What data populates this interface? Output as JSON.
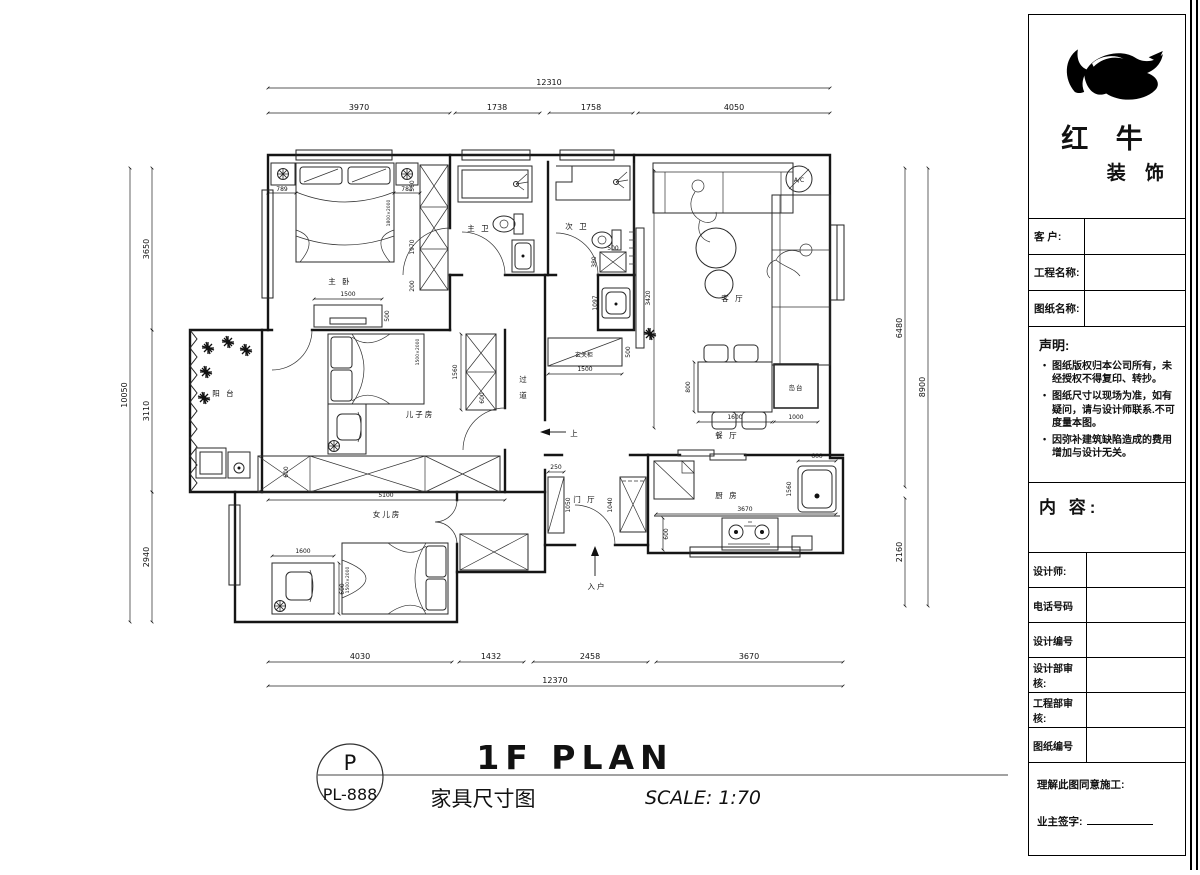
{
  "sidebar": {
    "brand_1": "红 牛",
    "brand_2": "装 饰",
    "fields_top": [
      {
        "label": "客  户:"
      },
      {
        "label": "工程名称:"
      },
      {
        "label": "图纸名称:"
      }
    ],
    "statement_title": "声明:",
    "statement_items": [
      "图纸版权归本公司所有，未经授权不得复印、转抄。",
      "图纸尺寸以现场为准，如有疑问，请与设计师联系.不可度量本图。",
      "因弥补建筑缺陷造成的费用增加与设计无关。"
    ],
    "content_label": "内 容:",
    "fields_bottom": [
      {
        "label": "设计师:"
      },
      {
        "label": "电话号码"
      },
      {
        "label": "设计编号"
      },
      {
        "label": "设计部审核:"
      },
      {
        "label": "工程部审核:"
      },
      {
        "label": "图纸编号"
      }
    ],
    "confirm_line": "理解此图同意施工:",
    "sign_line": "业主签字:"
  },
  "footer": {
    "code_top": "P",
    "code_bottom": "PL-888",
    "title": "1F PLAN",
    "subtitle": "家具尺寸图",
    "scale": "SCALE: 1:70"
  },
  "plan": {
    "rooms": {
      "master": "主 卧",
      "master_bath": "主 卫",
      "second_bath": "次 卫",
      "living": "客 厅",
      "balcony": "阳 台",
      "son": "儿子房",
      "corridor_1": "过",
      "corridor_2": "道",
      "entry_cabinet": "玄关柜",
      "dining": "餐 厅",
      "island": "岛台",
      "kitchen": "厨 房",
      "foyer": "门 厅",
      "daughter": "女儿房",
      "entry": "入户",
      "up": "上",
      "ac": "A/C"
    },
    "beds": {
      "master": "1800×2000",
      "son": "1500×2000",
      "daughter": "1500×2000"
    },
    "dims": {
      "top_total": "12310",
      "top_a": "3970",
      "top_b": "1738",
      "top_c": "1758",
      "top_d": "4050",
      "bottom_a": "4030",
      "bottom_b": "1432",
      "bottom_c": "2458",
      "bottom_d": "3670",
      "bottom_total": "12370",
      "left_a": "3650",
      "left_b": "3110",
      "left_c": "2940",
      "left_total": "10050",
      "right_a": "6480",
      "right_b": "2160",
      "right_total": "8900",
      "master_left": "789",
      "master_right": "781",
      "ward_top": "560",
      "ward_mid": "1970",
      "ward_bot": "200",
      "tv_w": "1500",
      "tv_d": "500",
      "bath_nook": "1097",
      "cw_w": "500",
      "cw_d": "380",
      "hall_cab_w": "1500",
      "hall_cab_d": "500",
      "living_h": "3420",
      "din_d": "800",
      "din_w": "1600",
      "island_w": "1000",
      "kit_w": "3670",
      "kit_d": "600",
      "sink_w": "600",
      "sink_h": "1560",
      "foyer_a": "250",
      "foyer_b": "1050",
      "foyer_c": "1040",
      "son_ward": "1560",
      "son_ward_d": "600",
      "son_cab": "5100",
      "son_cab_d": "600",
      "dau_desk": "1600",
      "dau_desk_d": "600"
    }
  }
}
